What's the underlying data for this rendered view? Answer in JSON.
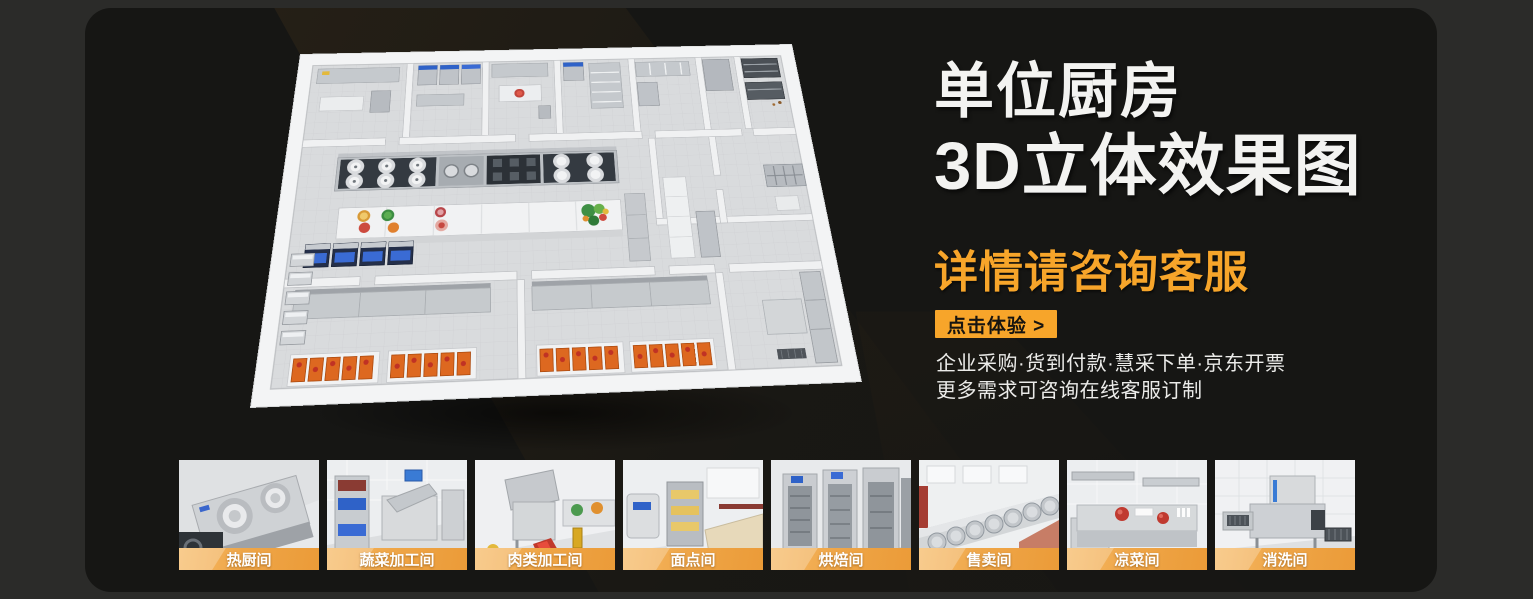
{
  "hero": {
    "title_line1": "单位厨房",
    "title_line2": "3D立体效果图",
    "subtitle": "详情请咨询客服",
    "cta_label": "点击体验 >",
    "desc_line1": "企业采购·货到付款·慧采下单·京东开票",
    "desc_line2": "更多需求可咨询在线客服订制"
  },
  "colors": {
    "accent_orange": "#f7a52a",
    "panel_bg": "#161614",
    "outer_bg": "#2b2b29"
  },
  "thumbnails": [
    {
      "label": "热厨间"
    },
    {
      "label": "蔬菜加工间"
    },
    {
      "label": "肉类加工间"
    },
    {
      "label": "面点间"
    },
    {
      "label": "烘焙间"
    },
    {
      "label": "售卖间"
    },
    {
      "label": "凉菜间"
    },
    {
      "label": "消洗间"
    }
  ]
}
